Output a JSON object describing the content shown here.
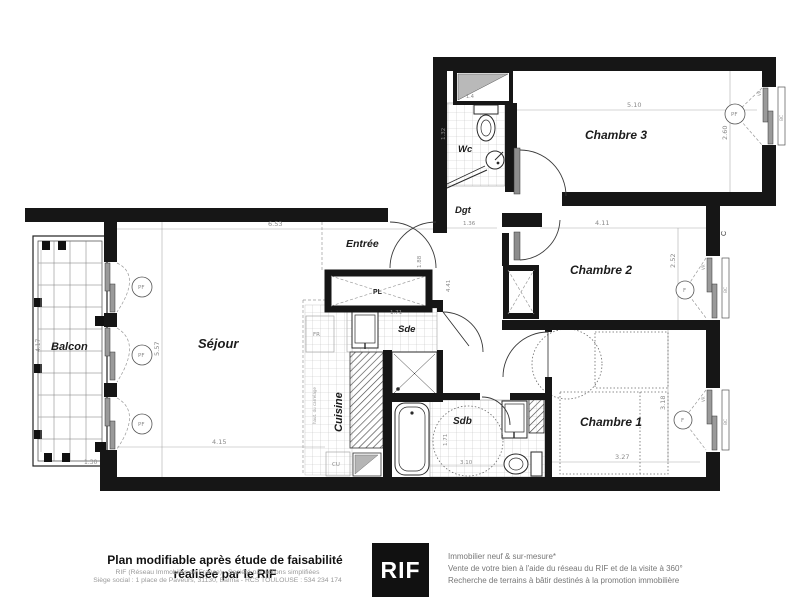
{
  "plan": {
    "rooms": {
      "balcon": {
        "name": "Balcon",
        "dims": {
          "height": "4.17",
          "width": "1.30"
        }
      },
      "sejour": {
        "name": "Séjour",
        "dims": {
          "top": "6.53",
          "left": "5.57",
          "bottom": "4.15"
        }
      },
      "cuisine": {
        "name": "Cuisine",
        "labels": {
          "fridge": "FR",
          "cooker": "CU",
          "note": "haut. du carrelage"
        }
      },
      "entree": {
        "name": "Entrée",
        "closet": "PL",
        "dims": {
          "passage": "1.88",
          "hall": "4.41"
        }
      },
      "sde": {
        "name": "Sde",
        "dims": {
          "width": "1.71"
        }
      },
      "sdb": {
        "name": "Sdb",
        "dims": {
          "height": "1.71",
          "width": "3.10"
        }
      },
      "wc": {
        "name": "Wc",
        "dims": {
          "height": "1.32",
          "width": "1.4"
        }
      },
      "dgt": {
        "name": "Dgt",
        "dims": {
          "width": "1.36"
        }
      },
      "chambre1": {
        "name": "Chambre 1",
        "dims": {
          "width": "3.27",
          "height": "3.18"
        }
      },
      "chambre2": {
        "name": "Chambre 2",
        "dims": {
          "width": "4.11",
          "height": "2.52"
        }
      },
      "chambre3": {
        "name": "Chambre 3",
        "dims": {
          "width": "5.10",
          "height": "2.60"
        }
      }
    },
    "window_labels": {
      "pf": "PF",
      "f": "F",
      "vr": "VR",
      "bc": "BC"
    },
    "marker_c": "C"
  },
  "footer": {
    "left": {
      "title": "Plan modifiable après étude de faisabilité réalisée par le RIF",
      "line2": "RIF (Réseau Immobilier de France) - Société par actions simplifiées",
      "line3": "Siège social : 1 place de Paveurs, 31130, Balma - RCS TOULOUSE : 534 234 174"
    },
    "logo": "RIF",
    "right": {
      "line1": "Immobilier neuf & sur-mesure*",
      "line2": "Vente de votre bien à l'aide du réseau du RIF et de la visite à 360°",
      "line3": "Recherche de terrains à bâtir destinés à la promotion immobilière"
    }
  }
}
